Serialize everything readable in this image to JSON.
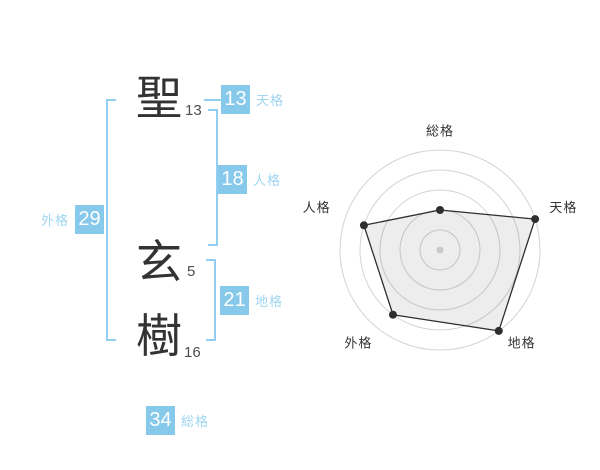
{
  "page": {
    "background": "#ffffff"
  },
  "name_panel": {
    "characters": [
      {
        "char": "聖",
        "strokes": "13"
      },
      {
        "char": "玄",
        "strokes": "5"
      },
      {
        "char": "樹",
        "strokes": "16"
      }
    ],
    "badges": [
      {
        "id": "tenkaku",
        "value": "13",
        "label": "天格"
      },
      {
        "id": "jinkaku",
        "value": "18",
        "label": "人格"
      },
      {
        "id": "chikaku",
        "value": "21",
        "label": "地格"
      },
      {
        "id": "gaikaku",
        "value": "29",
        "label": "外格"
      },
      {
        "id": "soukaku",
        "value": "34",
        "label": "総格"
      }
    ],
    "colors": {
      "badge_bg": "#87c9ea",
      "badge_text": "#ffffff",
      "label_text": "#9ed5f1",
      "bracket": "#90cfef",
      "kanji": "#333333",
      "strokes": "#4d4d4d"
    }
  },
  "chart_data": {
    "type": "radar",
    "axes": [
      "総格",
      "天格",
      "地格",
      "外格",
      "人格"
    ],
    "values": [
      40,
      100,
      100,
      80,
      80
    ],
    "max": 100,
    "rings": 5,
    "grid": "circular",
    "legend": false,
    "colors": {
      "ring": "#d4d4d4",
      "polygon_stroke": "#2e2e2e",
      "polygon_fill": "#000000",
      "polygon_fill_opacity": "0.07",
      "vertex_dot": "#2e2e2e",
      "center_dot": "#c9c9c9",
      "label": "#333333"
    }
  }
}
